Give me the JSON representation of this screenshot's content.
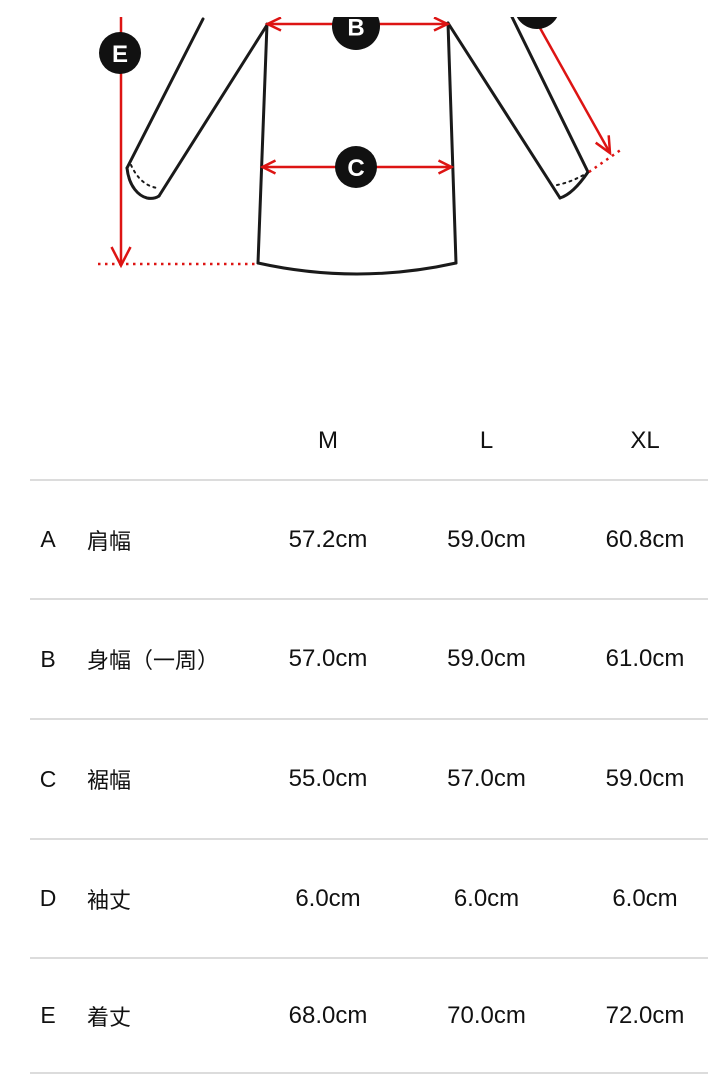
{
  "page": {
    "background": "#ffffff"
  },
  "diagram": {
    "type": "garment-measurement-diagram",
    "badges": {
      "b": "B",
      "c": "C",
      "e": "E"
    },
    "colors": {
      "arrow": "#dd1413",
      "outline": "#1a1a1a",
      "badge_bg": "#111111",
      "badge_text": "#ffffff"
    }
  },
  "size_table": {
    "columns": [
      "M",
      "L",
      "XL"
    ],
    "rows": [
      {
        "key": "A",
        "label": "肩幅",
        "values": [
          "57.2cm",
          "59.0cm",
          "60.8cm"
        ]
      },
      {
        "key": "B",
        "label": "身幅（一周）",
        "values": [
          "57.0cm",
          "59.0cm",
          "61.0cm"
        ]
      },
      {
        "key": "C",
        "label": "裾幅",
        "values": [
          "55.0cm",
          "57.0cm",
          "59.0cm"
        ]
      },
      {
        "key": "D",
        "label": "袖丈",
        "values": [
          "6.0cm",
          "6.0cm",
          "6.0cm"
        ]
      },
      {
        "key": "E",
        "label": "着丈",
        "values": [
          "68.0cm",
          "70.0cm",
          "72.0cm"
        ]
      }
    ],
    "divider_color": "#dcdcdc",
    "text_color": "#111111"
  }
}
